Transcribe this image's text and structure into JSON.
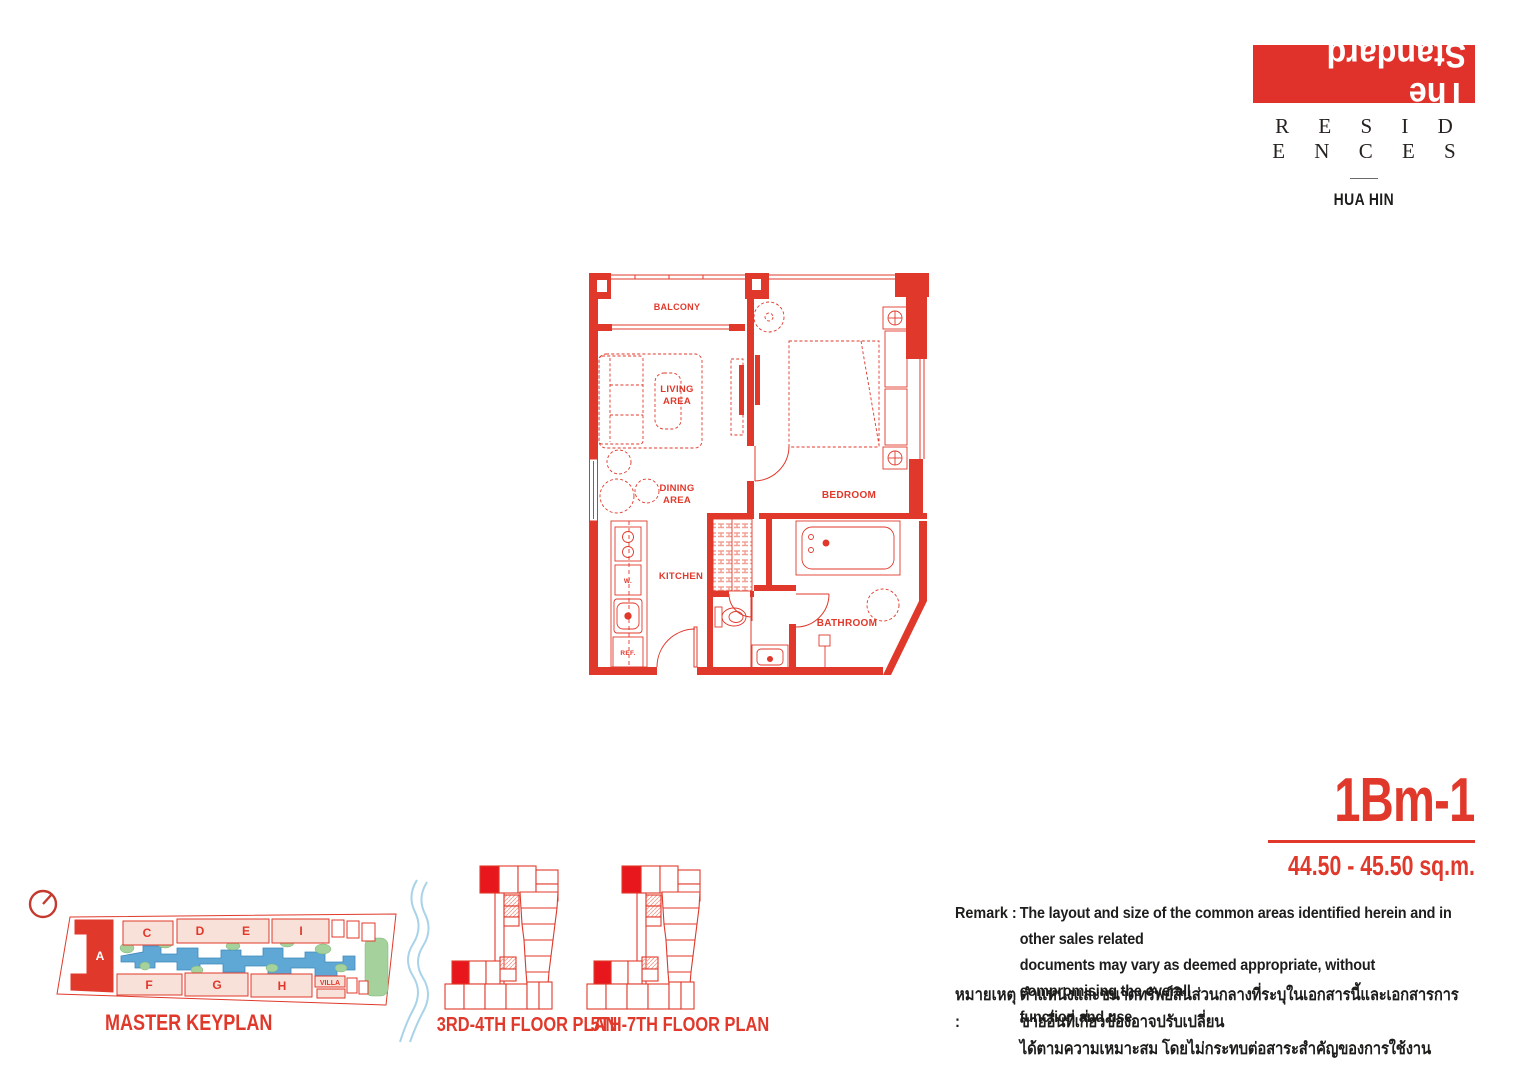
{
  "brand": {
    "logo": "The Standard",
    "residences": "R E S I D E N C E S",
    "location": "HUA HIN"
  },
  "unit": {
    "code": "1Bm-1",
    "area": "44.50 - 45.50 sq.m."
  },
  "plan": {
    "balcony": "BALCONY",
    "living1": "LIVING",
    "living2": "AREA",
    "dining1": "DINING",
    "dining2": "AREA",
    "kitchen": "KITCHEN",
    "bedroom": "BEDROOM",
    "bathroom": "BATHROOM",
    "washer": "W.",
    "fridge": "REF."
  },
  "keyplan": {
    "title": "MASTER KEYPLAN",
    "buildings": {
      "a": "A",
      "c": "C",
      "d": "D",
      "e": "E",
      "i": "I",
      "f": "F",
      "g": "G",
      "h": "H",
      "villa": "VILLA"
    }
  },
  "floorplans": {
    "plan34": "3RD-4TH FLOOR PLAN",
    "plan57": "5TH-7TH FLOOR PLAN"
  },
  "remark_en": {
    "label": "Remark :",
    "line1": "The layout and size of the common areas identified herein and in other sales related",
    "line2": "documents may vary as deemed appropriate, without compromising the overall",
    "line3": "function and use."
  },
  "remark_th": {
    "label": "หมายเหตุ :",
    "line1": "ตำแหน่งและขนาดทรัพย์สินส่วนกลางที่ระบุในเอกสารนี้และเอกสารการขายอื่นที่เกี่ยวข้องอาจปรับเปลี่ยน",
    "line2": "ได้ตามความเหมาะสม โดยไม่กระทบต่อสาระสำคัญของการใช้งาน"
  },
  "colors": {
    "red": "#e0392b",
    "dark": "#1d1d1b",
    "building_pink": "#f8e1d9",
    "pool_blue": "#5fa8d5",
    "landscape_green": "#a5d29c",
    "sea_blue": "#a8d3e8"
  }
}
